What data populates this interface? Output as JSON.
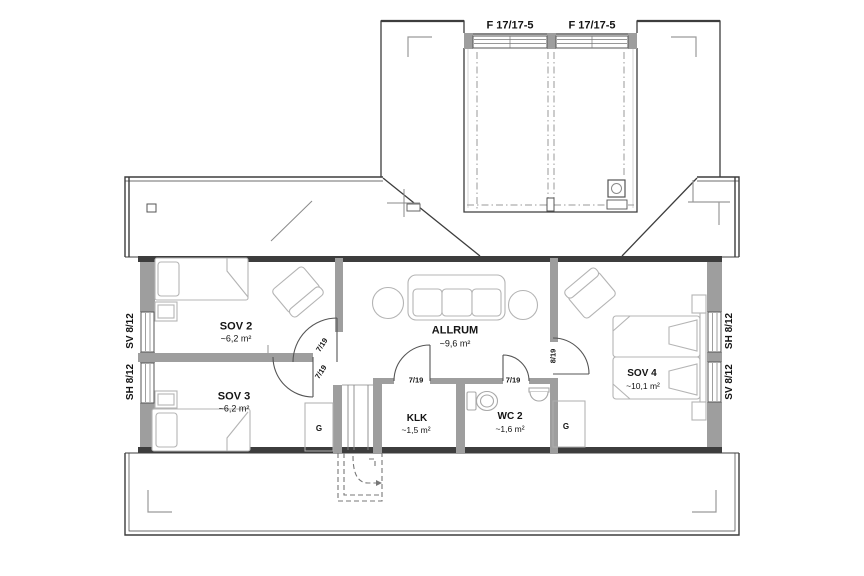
{
  "plan": {
    "dormer_windows": {
      "left": "F 17/17-5",
      "right": "F 17/17-5"
    },
    "side_windows": {
      "left_top": "SV 8/12",
      "left_bottom": "SH 8/12",
      "right_top": "SH 8/12",
      "right_bottom": "SV 8/12"
    },
    "rooms": {
      "sov2": {
        "name": "SOV 2",
        "area": "~6,2 m²"
      },
      "sov3": {
        "name": "SOV 3",
        "area": "~6,2 m²"
      },
      "allrum": {
        "name": "ALLRUM",
        "area": "~9,6 m²"
      },
      "klk": {
        "name": "KLK",
        "area": "~1,5 m²"
      },
      "wc2": {
        "name": "WC 2",
        "area": "~1,6 m²"
      },
      "sov4": {
        "name": "SOV 4",
        "area": "~10,1 m²"
      }
    },
    "doors": {
      "sov2": "7/19",
      "sov3": "7/19",
      "klk": "7/19",
      "wc2": "7/19",
      "sov4": "8/19"
    },
    "closets": {
      "sov3": "G",
      "sov4": "G"
    },
    "colors": {
      "wall_dark": "#3d3d3d",
      "wall_gray": "#9e9e9e",
      "furniture": "#b4b4b4",
      "text": "#141414"
    }
  }
}
